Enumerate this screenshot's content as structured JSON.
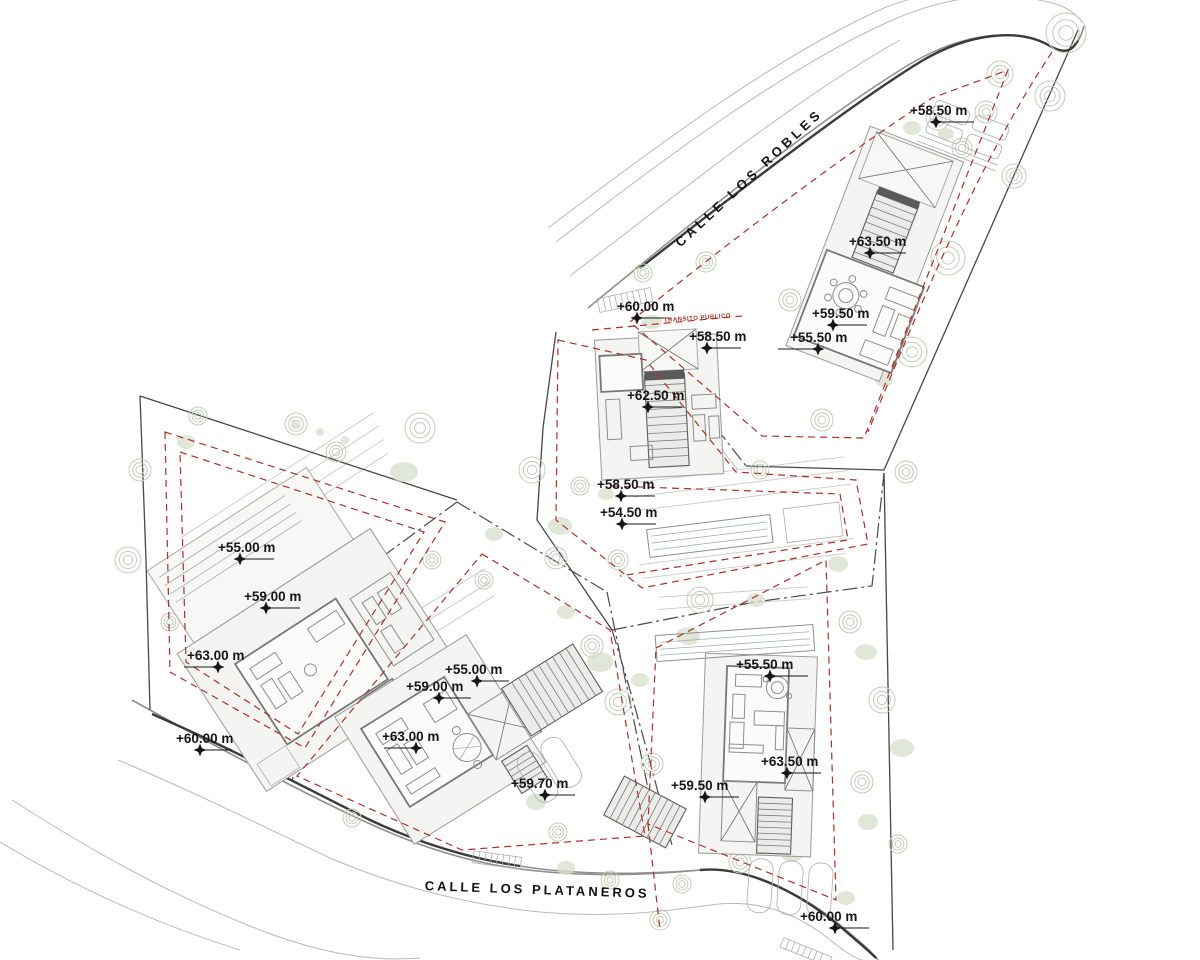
{
  "drawing": {
    "kind": "architectural-site-plan",
    "streets": [
      {
        "id": "calle-los-robles",
        "name": "CALLE LOS ROBLES",
        "x": 752,
        "y": 181,
        "rotation": -43,
        "letter_spacing": 4
      },
      {
        "id": "calle-los-plataneros",
        "name": "CALLE LOS PLATANEROS",
        "x": 537,
        "y": 894,
        "rotation": 2,
        "letter_spacing": 3
      }
    ],
    "easement_label": {
      "text": "TRANSITO PUBLICO",
      "x": 664,
      "y": 322,
      "rotation": -4,
      "color": "#a93226"
    },
    "elevation_markers": [
      {
        "label": "+58.50 m",
        "tx": 910,
        "sx": 936,
        "sy": 122,
        "dx": 38
      },
      {
        "label": "+63.50 m",
        "tx": 849,
        "sx": 870,
        "sy": 253,
        "dx": 36
      },
      {
        "label": "+59.50 m",
        "tx": 812,
        "sx": 833,
        "sy": 325,
        "dx": 34
      },
      {
        "label": "+55.50 m",
        "tx": 790,
        "sx": 818,
        "sy": 349,
        "dx": -40
      },
      {
        "label": "+60.00 m",
        "tx": 617,
        "sx": 637,
        "sy": 318,
        "dx": 34
      },
      {
        "label": "+58.50 m",
        "tx": 689,
        "sx": 707,
        "sy": 348,
        "dx": 34
      },
      {
        "label": "+62.50 m",
        "tx": 627,
        "sx": 648,
        "sy": 407,
        "dx": 34
      },
      {
        "label": "+58.50 m",
        "tx": 597,
        "sx": 621,
        "sy": 496,
        "dx": 34
      },
      {
        "label": "+54.50 m",
        "tx": 600,
        "sx": 622,
        "sy": 524,
        "dx": 34
      },
      {
        "label": "+55.00 m",
        "tx": 218,
        "sx": 240,
        "sy": 559,
        "dx": 34
      },
      {
        "label": "+59.00 m",
        "tx": 244,
        "sx": 266,
        "sy": 608,
        "dx": 34
      },
      {
        "label": "+63.00 m",
        "tx": 187,
        "sx": 218,
        "sy": 667,
        "dx": -34
      },
      {
        "label": "+60.00 m",
        "tx": 176,
        "sx": 200,
        "sy": 750,
        "dx": 32
      },
      {
        "label": "+55.00 m",
        "tx": 445,
        "sx": 477,
        "sy": 681,
        "dx": 32
      },
      {
        "label": "+59.00 m",
        "tx": 406,
        "sx": 439,
        "sy": 698,
        "dx": 32
      },
      {
        "label": "+63.00 m",
        "tx": 382,
        "sx": 416,
        "sy": 748,
        "dx": -32
      },
      {
        "label": "+59.70 m",
        "tx": 511,
        "sx": 545,
        "sy": 795,
        "dx": 30
      },
      {
        "label": "+55.50 m",
        "tx": 736,
        "sx": 770,
        "sy": 676,
        "dx": 38
      },
      {
        "label": "+63.50 m",
        "tx": 761,
        "sx": 787,
        "sy": 773,
        "dx": 34
      },
      {
        "label": "+59.50 m",
        "tx": 671,
        "sx": 705,
        "sy": 797,
        "dx": 34
      },
      {
        "label": "+60.00 m",
        "tx": 800,
        "sx": 835,
        "sy": 928,
        "dx": 34
      }
    ],
    "colors": {
      "setback_red": "#a93226",
      "boundary": "#474747",
      "road_gray": "#8f8f8f",
      "building_fill": "#f4f4f2",
      "vegetation": "#c2cdb8",
      "text": "#161616"
    }
  }
}
